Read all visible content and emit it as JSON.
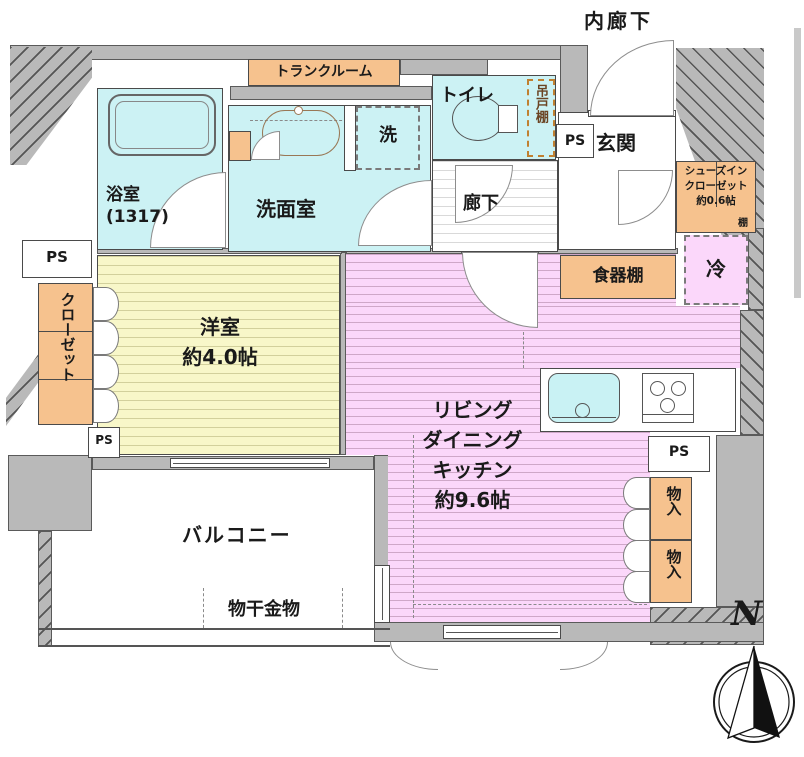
{
  "colors": {
    "wall": "#b9b9b9",
    "water_rooms": "#ccf2f4",
    "western_room": "#f8f7c9",
    "ldk": "#fbd7fa",
    "storage": "#f6c28e",
    "outline": "#4a4a4a"
  },
  "rooms": {
    "inner_corridor": {
      "label": "内廊下"
    },
    "trunk_room": {
      "label": "トランクルーム"
    },
    "bathroom": {
      "label": "浴室",
      "size": "(1317)"
    },
    "washroom": {
      "label": "洗面室"
    },
    "washer_space": {
      "label": "洗"
    },
    "toilet": {
      "label": "トイレ"
    },
    "hanging_cupboard": {
      "label": "吊戸棚"
    },
    "entrance": {
      "label": "玄関"
    },
    "shoes_in_closet": {
      "line1": "シューズイン",
      "line2": "クローゼット",
      "size": "約0.6帖",
      "shelf": "棚"
    },
    "refrigerator_space": {
      "label": "冷"
    },
    "cupboard": {
      "label": "食器棚"
    },
    "corridor": {
      "label": "廊下"
    },
    "closet": {
      "label": "クローゼット"
    },
    "western_room": {
      "label": "洋室",
      "size": "約4.0帖"
    },
    "ldk": {
      "line1": "リビング",
      "line2": "ダイニング",
      "line3": "キッチン",
      "size": "約9.6帖"
    },
    "storage_upper": {
      "label": "物入"
    },
    "storage_lower": {
      "label": "物入"
    },
    "balcony": {
      "label": "バルコニー"
    },
    "laundry_hardware": {
      "label": "物干金物"
    }
  },
  "pipe_space": {
    "label": "PS"
  },
  "compass": {
    "label": "N"
  }
}
